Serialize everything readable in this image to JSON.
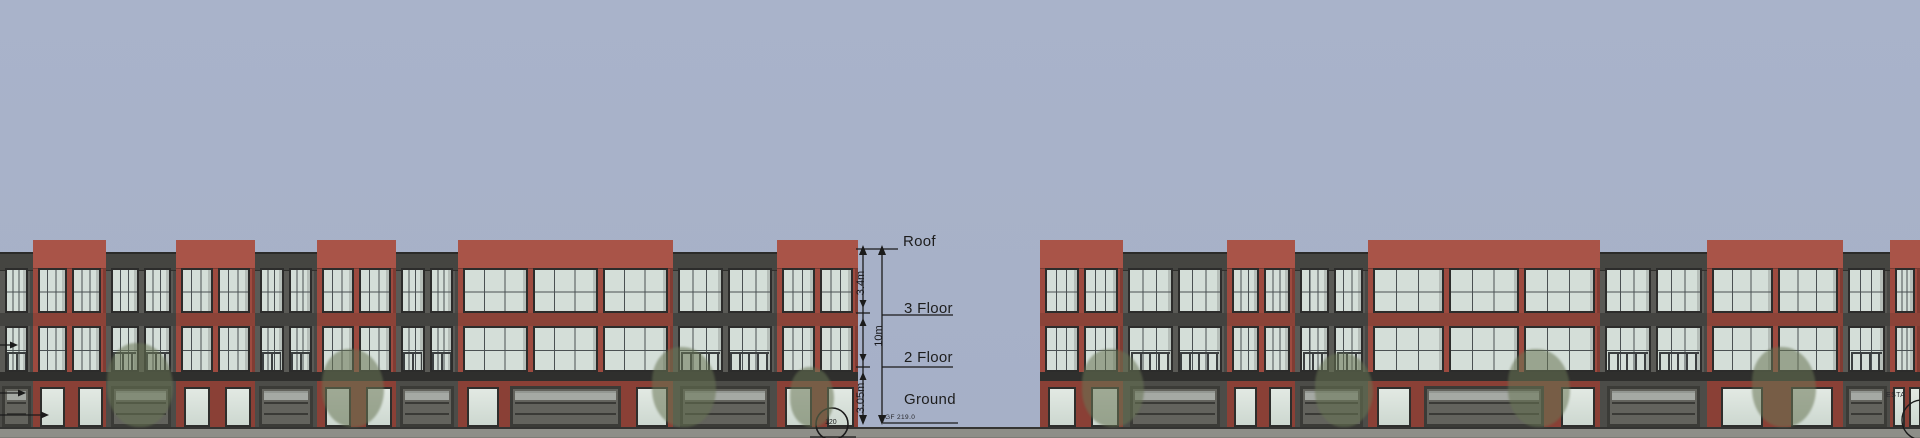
{
  "drawing": {
    "type": "architectural street elevation",
    "levels": [
      {
        "id": "roof",
        "label": "Roof",
        "y": 250
      },
      {
        "id": "floor3",
        "label": "3 Floor",
        "y": 313
      },
      {
        "id": "floor2",
        "label": "2 Floor",
        "y": 367
      },
      {
        "id": "ground",
        "label": "Ground",
        "y": 421
      }
    ],
    "dimensions": [
      {
        "label": "3.4m",
        "from": "roof",
        "to": "floor3",
        "x": 861,
        "yc": 283
      },
      {
        "label": "10m",
        "from": "roof",
        "to": "ground",
        "x": 879,
        "yc": 336
      },
      {
        "label": "3.05m",
        "from": "floor2",
        "to": "ground",
        "x": 861,
        "yc": 398
      }
    ],
    "ground_note": "GF 219.0",
    "callout_label": "120",
    "edge_note": "ESTA"
  },
  "colors": {
    "sky": "#a7b1c8",
    "sidewalk": "#8e8e88",
    "ground_line": "#343432",
    "annotation": "#1b1b1b",
    "glass": "#d4ded8",
    "window_frame": "#2c2c2b",
    "brick": {
      "facade": "#9d4a3f",
      "parapet": "#a95448",
      "spandrel": "#8b4338",
      "pier": "#8a4036"
    },
    "gray": {
      "facade": "#5a5a56",
      "parapet": "#454541",
      "spandrel": "#434340",
      "pier": "#4c4c48"
    },
    "garage_door": "#63635d",
    "tree": "#687454"
  },
  "buildings": [
    {
      "name": "left-block",
      "units": [
        {
          "x": 0,
          "w": 33,
          "c": "gray",
          "win": 1,
          "g": "garage"
        },
        {
          "x": 33,
          "w": 73,
          "c": "red",
          "win": 2,
          "g": "entry"
        },
        {
          "x": 106,
          "w": 70,
          "c": "gray",
          "win": 2,
          "g": "garage"
        },
        {
          "x": 176,
          "w": 79,
          "c": "red",
          "win": 2,
          "g": "entry"
        },
        {
          "x": 255,
          "w": 62,
          "c": "gray",
          "win": 2,
          "g": "garage"
        },
        {
          "x": 317,
          "w": 79,
          "c": "red",
          "win": 2,
          "g": "entry"
        },
        {
          "x": 396,
          "w": 62,
          "c": "gray",
          "win": 2,
          "g": "garage"
        },
        {
          "x": 458,
          "w": 215,
          "c": "red",
          "win": 3,
          "g": "mixed"
        },
        {
          "x": 673,
          "w": 104,
          "c": "gray",
          "win": 2,
          "g": "garage"
        },
        {
          "x": 777,
          "w": 81,
          "c": "red",
          "win": 2,
          "g": "entry"
        }
      ]
    },
    {
      "name": "right-block",
      "units": [
        {
          "x": 1040,
          "w": 83,
          "c": "red",
          "win": 2,
          "g": "entry"
        },
        {
          "x": 1123,
          "w": 104,
          "c": "gray",
          "win": 2,
          "g": "garage"
        },
        {
          "x": 1227,
          "w": 68,
          "c": "red",
          "win": 2,
          "g": "entry"
        },
        {
          "x": 1295,
          "w": 73,
          "c": "gray",
          "win": 2,
          "g": "garage"
        },
        {
          "x": 1368,
          "w": 232,
          "c": "red",
          "win": 3,
          "g": "mixed"
        },
        {
          "x": 1600,
          "w": 107,
          "c": "gray",
          "win": 2,
          "g": "garage"
        },
        {
          "x": 1707,
          "w": 136,
          "c": "red",
          "win": 2,
          "g": "entry"
        },
        {
          "x": 1843,
          "w": 47,
          "c": "gray",
          "win": 1,
          "g": "garage"
        },
        {
          "x": 1890,
          "w": 30,
          "c": "red",
          "win": 1,
          "g": "entry"
        }
      ]
    }
  ],
  "trees": [
    {
      "x": 107,
      "w": 66,
      "h": 84
    },
    {
      "x": 322,
      "w": 62,
      "h": 78
    },
    {
      "x": 652,
      "w": 64,
      "h": 80
    },
    {
      "x": 790,
      "w": 44,
      "h": 60
    },
    {
      "x": 1082,
      "w": 62,
      "h": 78
    },
    {
      "x": 1315,
      "w": 58,
      "h": 74
    },
    {
      "x": 1508,
      "w": 62,
      "h": 78
    },
    {
      "x": 1752,
      "w": 64,
      "h": 80
    }
  ]
}
